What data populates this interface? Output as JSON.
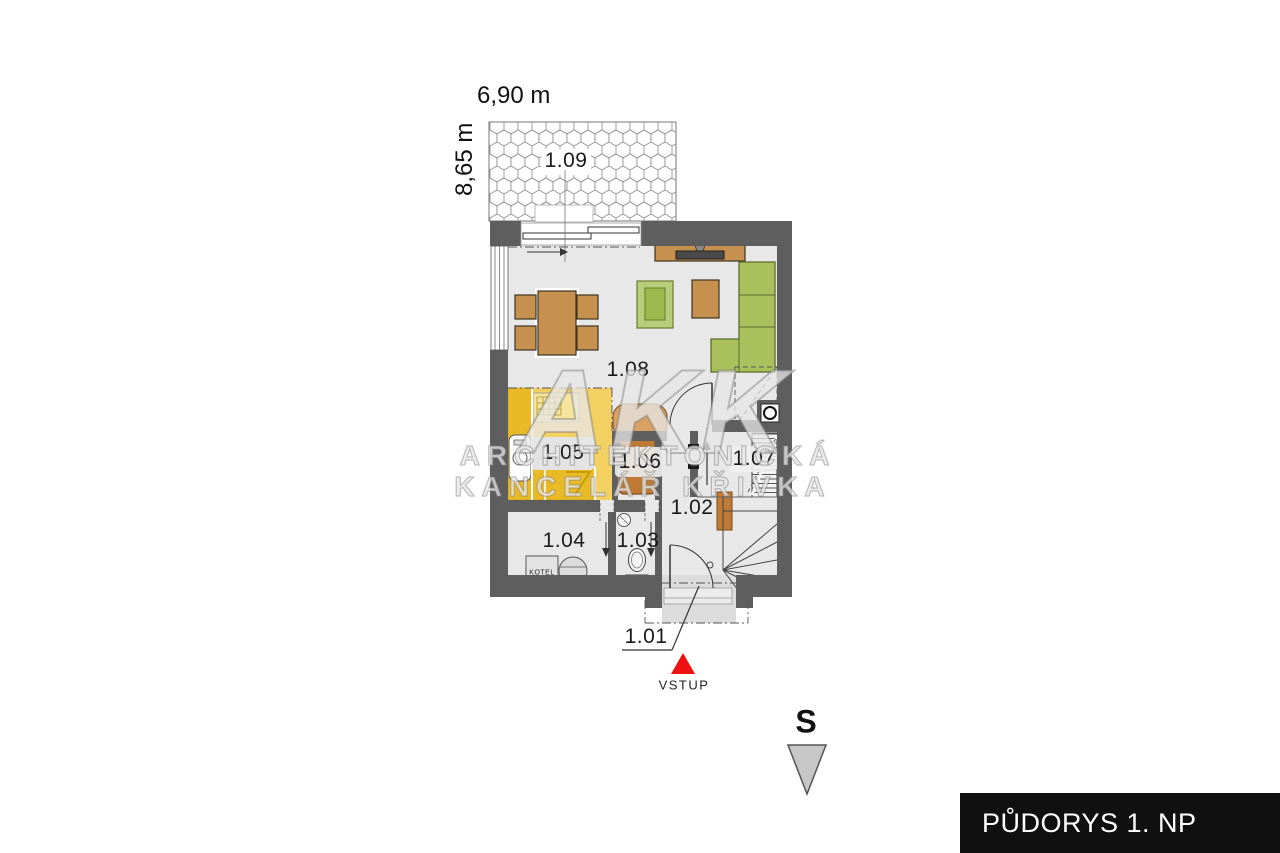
{
  "title_block": {
    "label": "PŮDORYS 1. NP",
    "bg_color": "#101010",
    "text_color": "#ffffff"
  },
  "plan": {
    "dimensions": {
      "width_label": "6,90 m",
      "height_label": "8,65 m"
    },
    "rooms": {
      "r101": {
        "label": "1.01"
      },
      "r102": {
        "label": "1.02"
      },
      "r103": {
        "label": "1.03"
      },
      "r104": {
        "label": "1.04"
      },
      "r105": {
        "label": "1.05"
      },
      "r106": {
        "label": "1.06"
      },
      "r107": {
        "label": "1.07"
      },
      "r108": {
        "label": "1.08"
      },
      "r109": {
        "label": "1.09"
      }
    },
    "equipment": {
      "boiler_label": "KOTEL"
    },
    "entrance": {
      "label": "VSTUP",
      "marker_color": "#ee1111"
    },
    "compass": {
      "north_label": "S"
    }
  },
  "watermark": {
    "logo": "AKK",
    "line2": "ARCHITEKTONICKÁ",
    "line3": "KANCELÁŘ KŘIVKA"
  },
  "colors": {
    "wall": "#5e5e5e",
    "floor": "#e8e8e8",
    "kitchen_floor": "#f2d061",
    "kitchen_counter": "#e9ba25",
    "furniture_wood": "#c6904f",
    "sofa_green": "#a9c05c",
    "accent_red": "#ee1111",
    "north_arrow_gray": "#c7c7c7"
  }
}
